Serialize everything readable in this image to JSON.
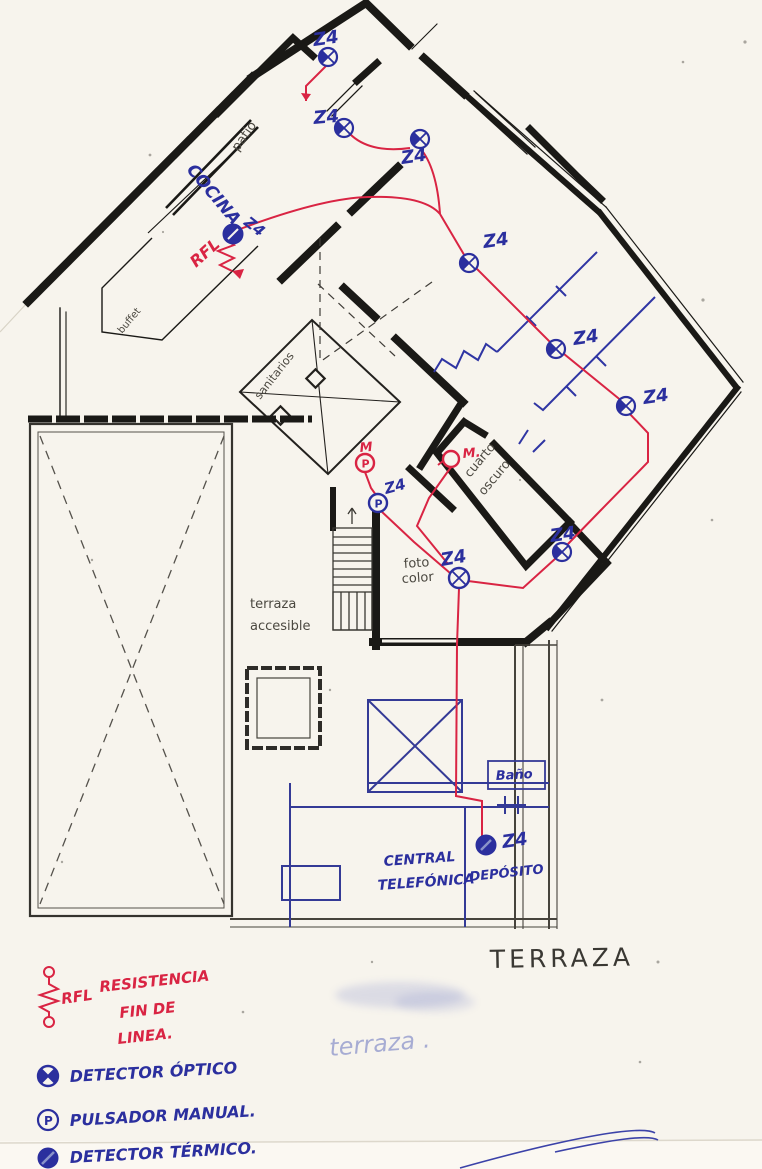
{
  "document": {
    "kind": "scanned hand-annotated floor plan with alarm detector layout"
  },
  "rooms": {
    "patio": "patio",
    "cocina": "COCINA",
    "buffet": "buffet",
    "sanitarios": "sanitarios",
    "cuarto_oscuro_line1": "cuarto",
    "cuarto_oscuro_line2": "oscuro",
    "foto_color_line1": "foto",
    "foto_color_line2": "color",
    "terraza_accesible_line1": "terraza",
    "terraza_accesible_line2": "accesible",
    "bano": "Baño",
    "central_telefonica_line1": "CENTRAL",
    "central_telefonica_line2": "TELEFÓNICA",
    "deposito": "DEPÓSITO",
    "terraza_title": "TERRAZA",
    "terraza_faint": "terraza ."
  },
  "annotations": {
    "zone": "Z4",
    "manual_m": "M",
    "manual_m_dot": "M.",
    "rfl": "RFL",
    "pulsador_letter": "P"
  },
  "legend": {
    "rfl_abbr": "RFL",
    "rfl_line1": "RESISTENCIA",
    "rfl_line2": "FIN DE",
    "rfl_line3": "LINEA.",
    "optical": "DETECTOR ÓPTICO",
    "manual": "PULSADOR MANUAL.",
    "thermal": "DETECTOR TÉRMICO."
  },
  "colors": {
    "paper": "#f7f4ed",
    "wall_ink": "#1a1916",
    "pencil": "#4b4840",
    "ink_blue": "#2b2f9e",
    "ink_red": "#d92443",
    "faint_blue": "#7d87c6"
  }
}
